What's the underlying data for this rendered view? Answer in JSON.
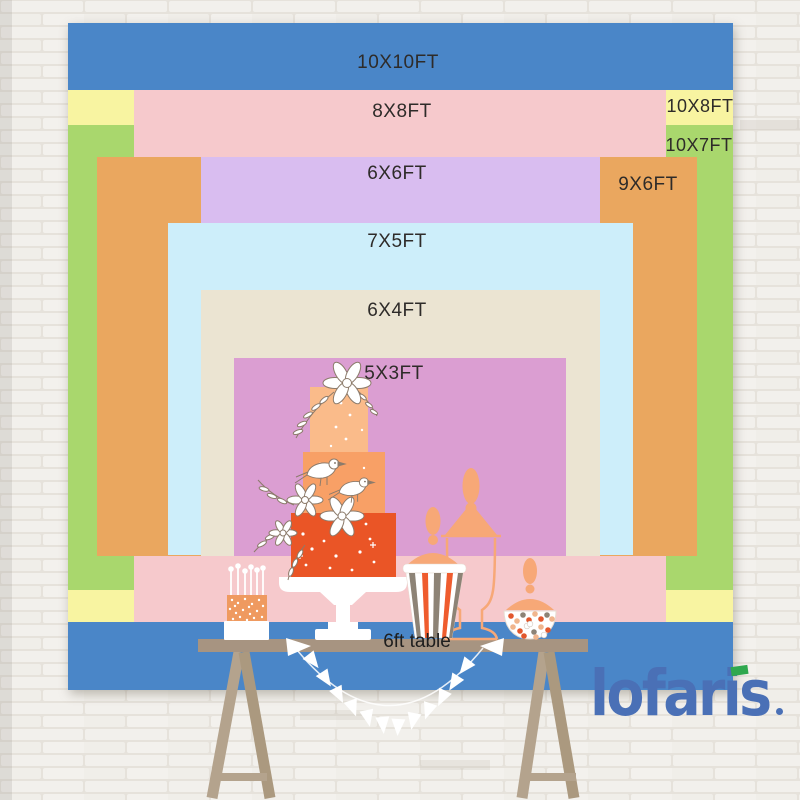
{
  "product": {
    "description": "backdrop size comparison",
    "table_label": "6ft table",
    "sizes": [
      {
        "id": "10x10",
        "label": "10X10FT",
        "color": "#4a86c8"
      },
      {
        "id": "10x8",
        "label": "10X8FT",
        "color": "#f8f4a1"
      },
      {
        "id": "10x7",
        "label": "10X7FT",
        "color": "#a9d76d"
      },
      {
        "id": "8x8",
        "label": "8X8FT",
        "color": "#f6c9cc"
      },
      {
        "id": "9x6",
        "label": "9X6FT",
        "color": "#eaa75f"
      },
      {
        "id": "6x6",
        "label": "6X6FT",
        "color": "#d9bdf0"
      },
      {
        "id": "7x5",
        "label": "7X5FT",
        "color": "#cdeefa"
      },
      {
        "id": "6x4",
        "label": "6X4FT",
        "color": "#ebe4d2"
      },
      {
        "id": "5x3",
        "label": "5X3FT",
        "color": "#db9ed2"
      }
    ]
  },
  "brand": {
    "logo_text": "lofaris",
    "logo_color": "#4a70b6",
    "logo_accent_green": "#2fa84e"
  }
}
